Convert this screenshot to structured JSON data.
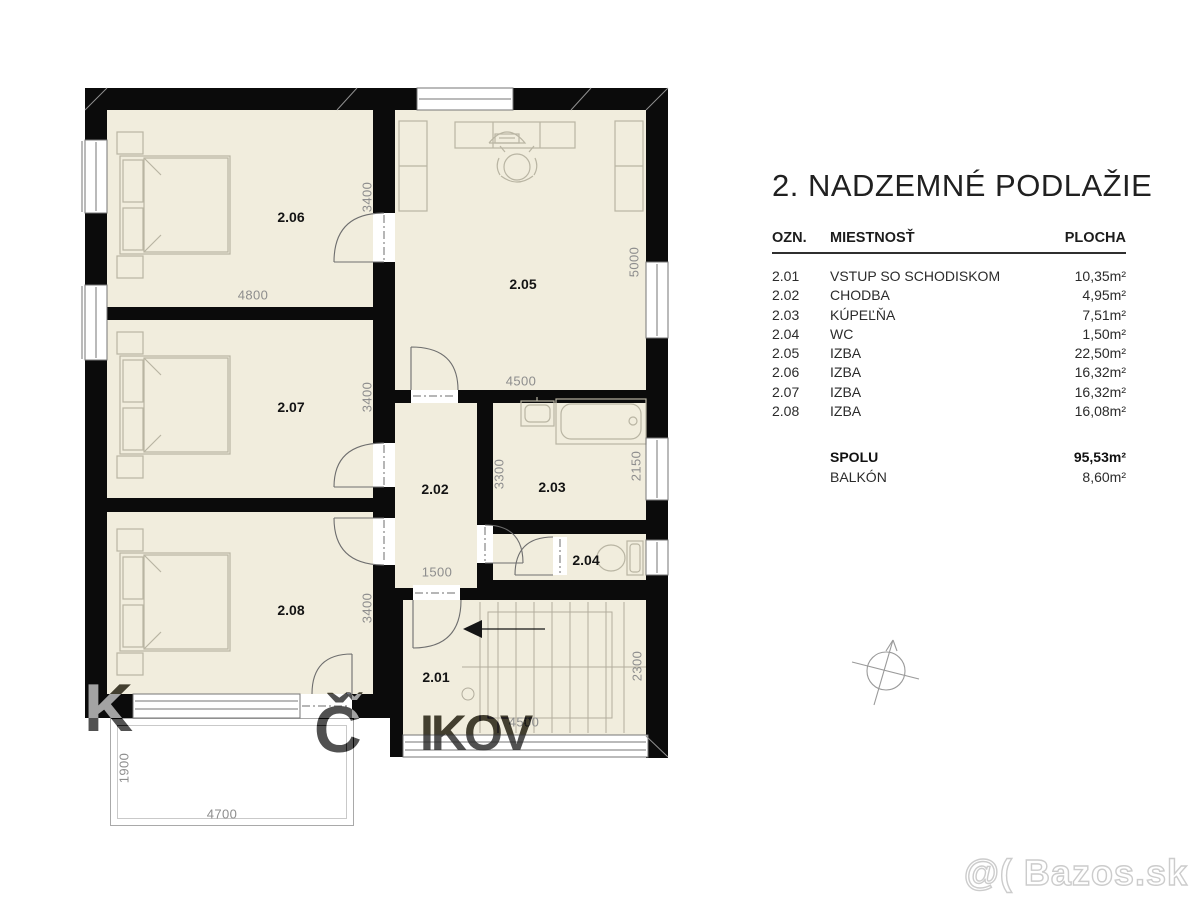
{
  "title": "2. NADZEMNÉ PODLAŽIE",
  "legend": {
    "headers": {
      "ozn": "OZN.",
      "room": "MIESTNOSŤ",
      "area": "PLOCHA"
    },
    "rows": [
      {
        "ozn": "2.01",
        "room": "VSTUP SO SCHODISKOM",
        "area": "10,35m²"
      },
      {
        "ozn": "2.02",
        "room": "CHODBA",
        "area": "4,95m²"
      },
      {
        "ozn": "2.03",
        "room": "KÚPEĽŇA",
        "area": "7,51m²"
      },
      {
        "ozn": "2.04",
        "room": "WC",
        "area": "1,50m²"
      },
      {
        "ozn": "2.05",
        "room": "IZBA",
        "area": "22,50m²"
      },
      {
        "ozn": "2.06",
        "room": "IZBA",
        "area": "16,32m²"
      },
      {
        "ozn": "2.07",
        "room": "IZBA",
        "area": "16,32m²"
      },
      {
        "ozn": "2.08",
        "room": "IZBA",
        "area": "16,08m²"
      }
    ],
    "total": {
      "label": "SPOLU",
      "area": "95,53m²"
    },
    "balcony": {
      "label": "BALKÓN",
      "area": "8,60m²"
    }
  },
  "plan": {
    "room_labels": [
      {
        "text": "2.01"
      },
      {
        "text": "2.02"
      },
      {
        "text": "2.03"
      },
      {
        "text": "2.04"
      },
      {
        "text": "2.05"
      },
      {
        "text": "2.06"
      },
      {
        "text": "2.07"
      },
      {
        "text": "2.08"
      }
    ],
    "dimensions": [
      {
        "text": "4800"
      },
      {
        "text": "3400"
      },
      {
        "text": "4500"
      },
      {
        "text": "5000"
      },
      {
        "text": "3400"
      },
      {
        "text": "3300"
      },
      {
        "text": "2150"
      },
      {
        "text": "1500"
      },
      {
        "text": "3400"
      },
      {
        "text": "2300"
      },
      {
        "text": "4500"
      },
      {
        "text": "1900"
      },
      {
        "text": "4700"
      }
    ]
  },
  "watermarks": {
    "frag_k": "K",
    "frag_caron": "ˇ",
    "frag_c": "Č",
    "frag_ikov": "IKOV",
    "bazos": "@( Bazos.sk"
  },
  "icons": {
    "compass": "north-arrow-icon"
  },
  "colors": {
    "wall": "#0b0b0b",
    "room_fill": "#f1eddd",
    "dimension_text": "#8d8d8d",
    "furniture_line": "#b9b5a3",
    "watermark_gray": "#aeaeae"
  }
}
